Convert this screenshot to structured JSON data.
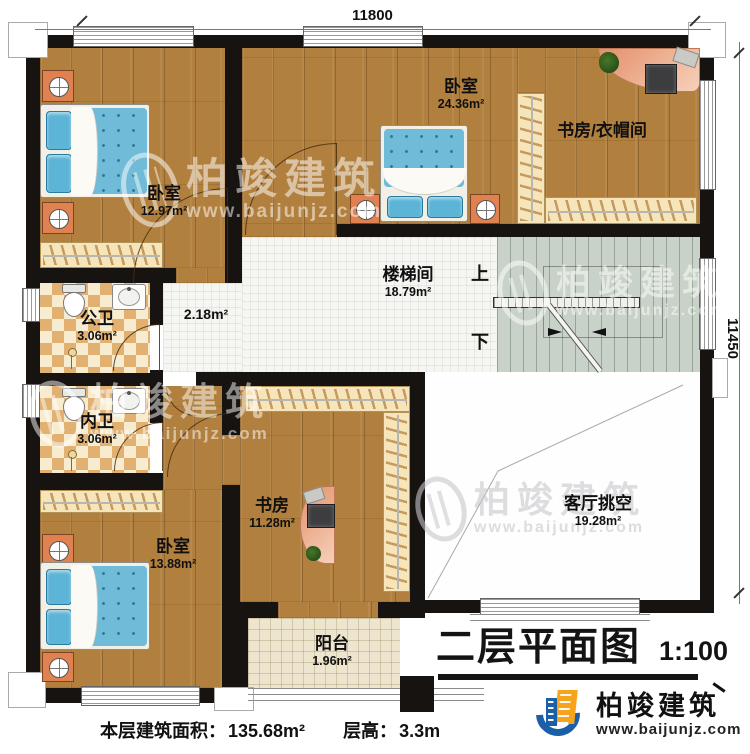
{
  "dims": {
    "top": "11800",
    "right": "11450"
  },
  "rooms": {
    "bedroom1": {
      "name": "卧室",
      "area": "12.97m²"
    },
    "bedroom2": {
      "name": "卧室",
      "area": "24.36m²"
    },
    "studyCloak": {
      "name": "书房/衣帽间"
    },
    "stairwell": {
      "name": "楼梯间",
      "area": "18.79m²"
    },
    "hallway": {
      "area": "2.18m²"
    },
    "publicBath": {
      "name": "公卫",
      "area": "3.06m²"
    },
    "privateBath": {
      "name": "内卫",
      "area": "3.06m²"
    },
    "study": {
      "name": "书房",
      "area": "11.28m²"
    },
    "bedroom3": {
      "name": "卧室",
      "area": "13.88m²"
    },
    "livingVoid": {
      "name": "客厅挑空",
      "area": "19.28m²"
    },
    "balcony": {
      "name": "阳台",
      "area": "1.96m²"
    }
  },
  "stairs": {
    "up": "上",
    "down": "下"
  },
  "title": {
    "text": "二层平面图",
    "scale": "1:100"
  },
  "footer": {
    "floor_area_label": "本层建筑面积：",
    "floor_area": "135.68m²",
    "height_label": "层高：",
    "height": "3.3m"
  },
  "brand": {
    "name": "柏竣建筑",
    "url": "www.baijunjz.com"
  },
  "watermark": {
    "name": "柏竣建筑",
    "url": "www.baijunjz.com"
  },
  "colors": {
    "wall": "#171310",
    "wood": "#b2803e",
    "tile": "#f5f5f1",
    "stairs": "#c9d2c9",
    "brand_blue": "#1a5fa8",
    "brand_orange": "#f7a31b",
    "mattress": "#6fbbd8"
  }
}
